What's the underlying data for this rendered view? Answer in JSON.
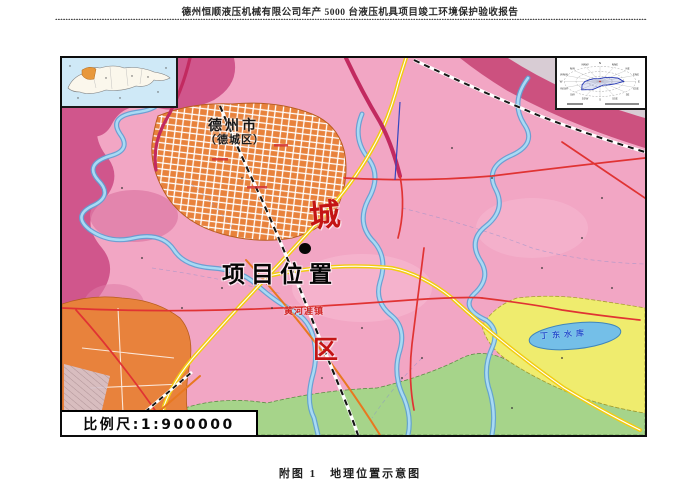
{
  "page": {
    "header_title": "德州恒顺液压机械有限公司年产 5000 台液压机具项目竣工环境保护验收报告",
    "caption": "附图 1　地理位置示意图"
  },
  "map": {
    "city_label": "德州市",
    "city_sublabel": "（德城区）",
    "big_char_cheng": "城",
    "big_char_qu": "区",
    "town_label": "黄河涯镇",
    "reservoir_label": "丁东水库",
    "project_label": "项目位置",
    "scale_label": "比例尺:1:900000",
    "wind_rose": {
      "directions": [
        "N",
        "NNE",
        "NE",
        "ENE",
        "E",
        "ESE",
        "SE",
        "SSE",
        "S",
        "SSW",
        "SW",
        "WSW",
        "W",
        "WNW",
        "NW",
        "NNW"
      ]
    },
    "colors": {
      "plain_pink": "#f2a6c4",
      "district_magenta": "#d0568c",
      "corner_mauve": "#d8ccd4",
      "urban_orange": "#e8823c",
      "farmland_yellow": "#efec6e",
      "farmland_green": "#a6d48a",
      "water_blue": "#a8daf4",
      "highway_yellow": "#f2cc12",
      "road_red": "#e03333",
      "road_crimson": "#c22a60",
      "label_red": "#c41414",
      "label_black": "#111111",
      "inset_sea_blue": "#cfe9f7",
      "inset_highlight_orange": "#e8983c"
    }
  }
}
